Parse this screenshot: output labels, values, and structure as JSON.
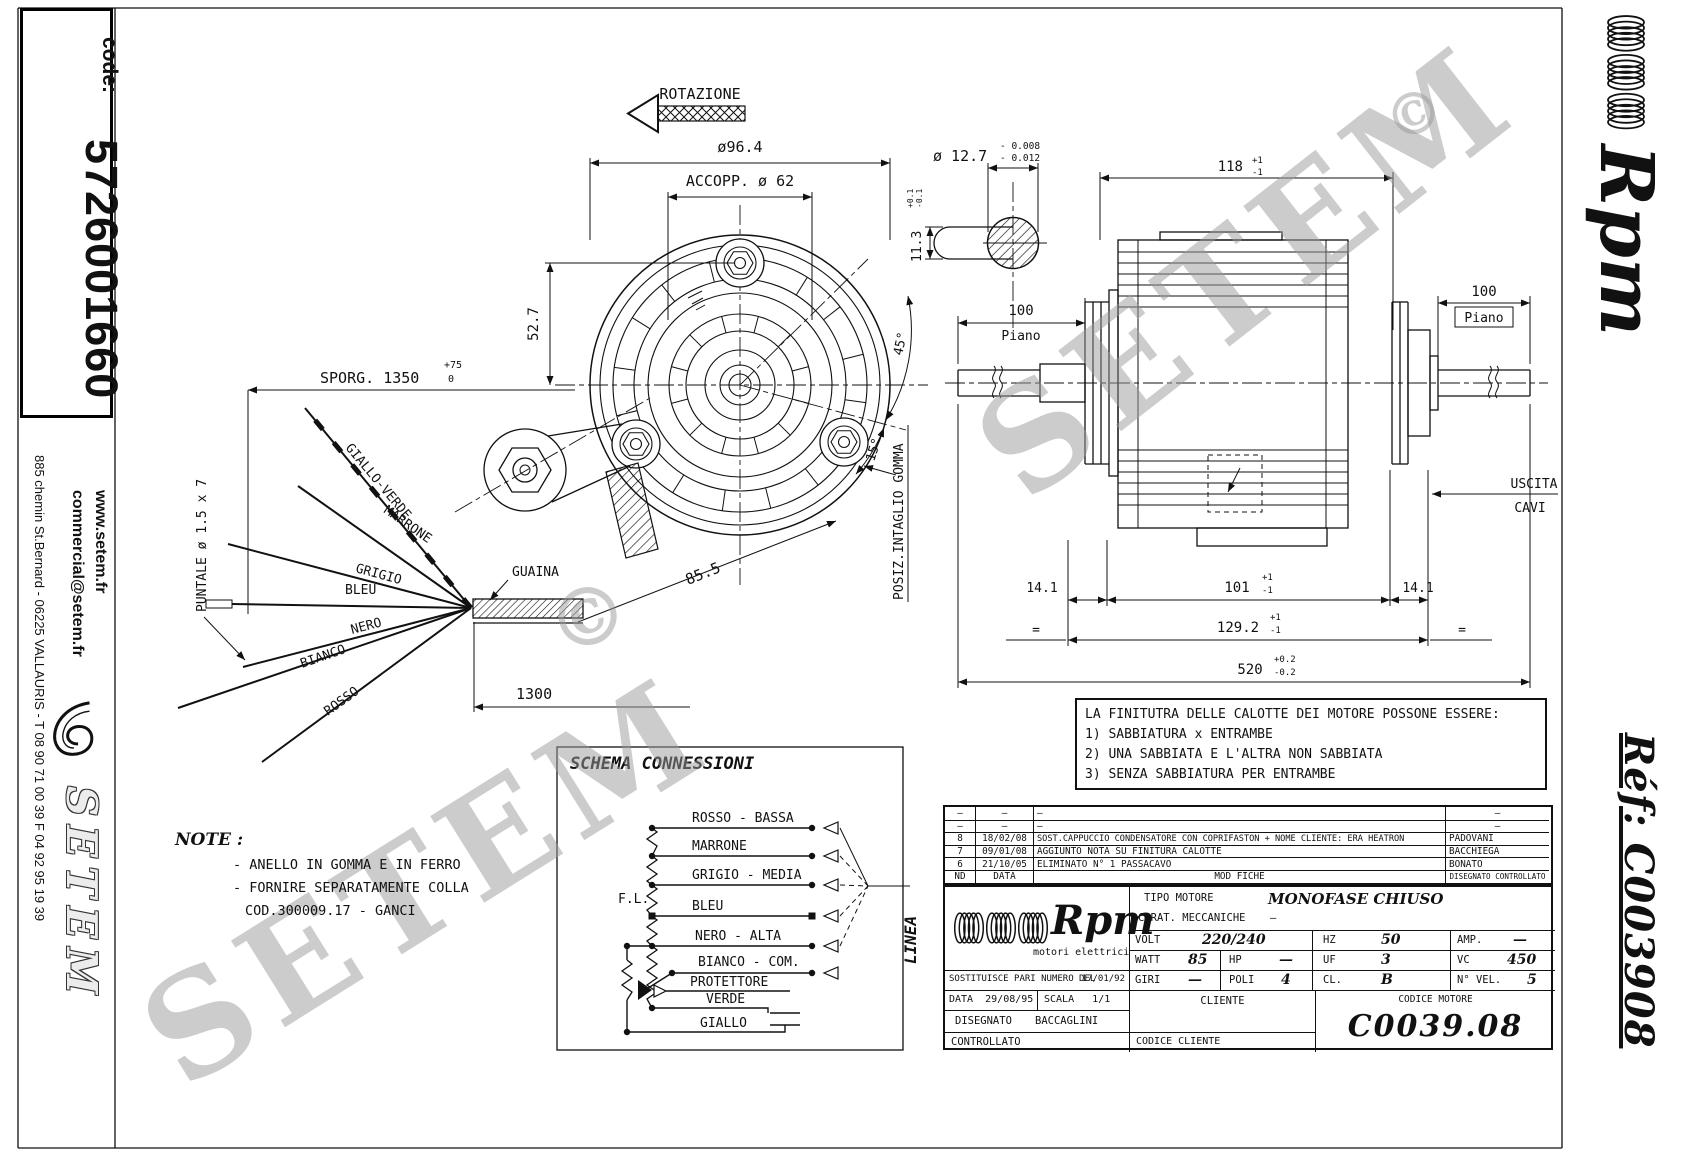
{
  "frame": {
    "code_label": "code:",
    "code_value": "5726001660",
    "website": "www.setem.fr",
    "email": "commercial@setem.fr",
    "address": "885 chemin St.Bernard  -  06225 VALLAURIS  -  T 08 90 71 00 39  F 04 92 95 19 39",
    "brand": "SETEM",
    "ref": "Réf:  C003908",
    "logo_script": "Rpm"
  },
  "watermark": {
    "text": "SETEM",
    "copyright": "©"
  },
  "front_view": {
    "rotation_label": "ROTAZIONE",
    "dia_outer": "ø96.4",
    "coupling": "ACCOPP. ø 62",
    "dim_52_7": "52.7",
    "dim_85_5": "85.5",
    "angle_45": "45°",
    "angle_15": "15°",
    "gomma_note": "POSIZ.INTAGLIO GOMMA"
  },
  "shaft_detail": {
    "dia": "ø 12.7",
    "tol_top": "- 0.008",
    "tol_bottom": "- 0.012",
    "width": "11.3",
    "w_tol_top": "+0.1",
    "w_tol_bottom": "-0.1"
  },
  "side_view": {
    "dim_118": "118",
    "dim_118_tol_top": "+1",
    "dim_118_tol_bottom": "-1",
    "dim_100_left": "100",
    "piano_left": "Piano",
    "dim_100_right": "100",
    "piano_right": "Piano",
    "dim_14_left": "14.1",
    "dim_14_right": "14.1",
    "dim_101": "101",
    "dim_101_tol_top": "+1",
    "dim_101_tol_bottom": "-1",
    "dim_129": "129.2",
    "dim_129_tol_top": "+1",
    "dim_129_tol_bottom": "-1",
    "dim_520": "520",
    "dim_520_tol_top": "+0.2",
    "dim_520_tol_bottom": "-0.2",
    "equal_left": "=",
    "equal_right": "=",
    "uscita": "USCITA",
    "cavi": "CAVI"
  },
  "cable": {
    "sporg": "SPORG. 1350",
    "sporg_tol_top": "+75",
    "sporg_tol_bottom": "0",
    "puntale": "PUNTALE ø 1.5 x 7",
    "guaina": "GUAINA",
    "dim_1300": "1300",
    "wires": [
      "GIALLO-VERDE",
      "MARRONE",
      "GRIGIO",
      "BLEU",
      "NERO",
      "BIANCO",
      "ROSSO"
    ]
  },
  "note": {
    "title": "NOTE :",
    "line1": "- ANELLO IN GOMMA E IN FERRO",
    "line2": "- FORNIRE SEPARATAMENTE COLLA",
    "line3": "COD.300009.17 - GANCI"
  },
  "finish_note": {
    "line0": "LA FINITUTRA DELLE CALOTTE DEI MOTORE POSSONE ESSERE:",
    "line1": "1) SABBIATURA x ENTRAMBE",
    "line2": "2) UNA SABBIATA E L'ALTRA NON SABBIATA",
    "line3": "3) SENZA SABBIATURA PER ENTRAMBE"
  },
  "schema": {
    "title": "SCHEMA CONNESSIONI",
    "fl": "F.L.",
    "linea": "LINEA",
    "labels": {
      "rosso": "ROSSO - BASSA",
      "marrone": "MARRONE",
      "grigio": "GRIGIO - MEDIA",
      "bleu": "BLEU",
      "nero": "NERO - ALTA",
      "bianco": "BIANCO - COM.",
      "protettore": "PROTETTORE",
      "verde": "VERDE",
      "giallo": "GIALLO"
    }
  },
  "revisions": {
    "rows": [
      {
        "nd": "–",
        "date": "–",
        "mod": "–",
        "name": "–"
      },
      {
        "nd": "–",
        "date": "–",
        "mod": "–",
        "name": "–"
      },
      {
        "nd": "8",
        "date": "18/02/08",
        "mod": "SOST.CAPPUCCIO CONDENSATORE CON COPRIFASTON + NOME CLIENTE: ERA HEATRON",
        "name": "PADOVANI"
      },
      {
        "nd": "7",
        "date": "09/01/08",
        "mod": "AGGIUNTO NOTA SU FINITURA CALOTTE",
        "name": "BACCHIEGA"
      },
      {
        "nd": "6",
        "date": "21/10/05",
        "mod": "ELIMINATO N° 1 PASSACAVO",
        "name": "BONATO"
      }
    ],
    "header": {
      "nd": "ND",
      "date": "DATA",
      "mod": "MOD FICHE",
      "name": "DISEGNATO CONTROLLATO"
    }
  },
  "title_block": {
    "logo_script": "Rpm",
    "logo_sub": "motori elettrici",
    "tipo_label": "TIPO MOTORE",
    "tipo_value": "MONOFASE CHIUSO",
    "carat_label": "CARAT. MECCANICHE",
    "carat_value": "—",
    "volt_label": "VOLT",
    "volt_value": "220/240",
    "hz_label": "HZ",
    "hz_value": "50",
    "amp_label": "AMP.",
    "amp_value": "—",
    "watt_label": "WATT",
    "watt_value": "85",
    "hp_label": "HP",
    "hp_value": "—",
    "uf_label": "UF",
    "uf_value": "3",
    "vc_label": "VC",
    "vc_value": "450",
    "giri_label": "GIRI",
    "giri_value": "—",
    "poli_label": "POLI",
    "poli_value": "4",
    "cl_label": "CL.",
    "cl_value": "B",
    "nvel_label": "N° VEL.",
    "nvel_value": "5",
    "sostituisce_label": "SOSTITUISCE PARI NUMERO DEL",
    "sostituisce_date": "17/01/92",
    "data_label": "DATA",
    "data_value": "29/08/95",
    "scala_label": "SCALA",
    "scala_value": "1/1",
    "disegnato_label": "DISEGNATO",
    "disegnato_value": "BACCAGLINI",
    "controllato_label": "CONTROLLATO",
    "cliente_label": "CLIENTE",
    "codice_motore_label": "CODICE MOTORE",
    "codice_motore_value": "C0039.08",
    "codice_cliente_label": "CODICE CLIENTE"
  }
}
